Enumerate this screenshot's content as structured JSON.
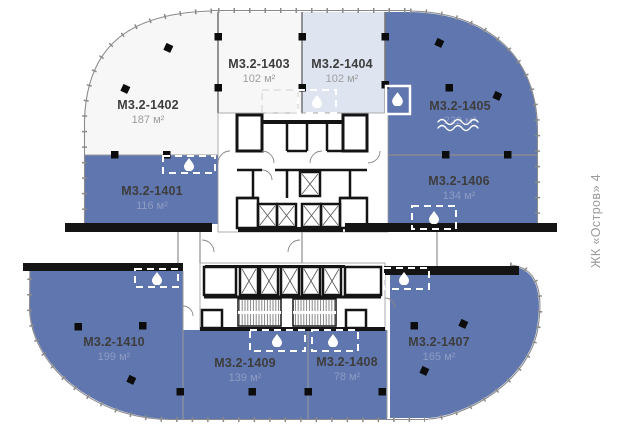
{
  "plan": {
    "vertical_label": "ЖК «Остров» 4",
    "units": [
      {
        "id": "М3.2-1401",
        "area": "116 м²",
        "fill": "#6076ae"
      },
      {
        "id": "М3.2-1402",
        "area": "187 м²",
        "fill": "#f7f7f7"
      },
      {
        "id": "М3.2-1403",
        "area": "102 м²",
        "fill": "#f7f7f7"
      },
      {
        "id": "М3.2-1404",
        "area": "102 м²",
        "fill": "#dee4f0"
      },
      {
        "id": "М3.2-1405",
        "area": "222 м²",
        "fill": "#6076ae"
      },
      {
        "id": "М3.2-1406",
        "area": "134 м²",
        "fill": "#6076ae"
      },
      {
        "id": "М3.2-1407",
        "area": "165 м²",
        "fill": "#6076ae"
      },
      {
        "id": "М3.2-1408",
        "area": "78 м²",
        "fill": "#6076ae"
      },
      {
        "id": "М3.2-1409",
        "area": "139 м²",
        "fill": "#6076ae"
      },
      {
        "id": "М3.2-1410",
        "area": "199 м²",
        "fill": "#6076ae"
      }
    ],
    "colors": {
      "unit_blue": "#6076ae",
      "unit_light_blue": "#dee4f0",
      "unit_white": "#f7f7f7",
      "wall": "#141414",
      "label_text": "#3d3d3d",
      "area_on_blue": "#8e9cc5",
      "area_on_white": "#9e9e9e",
      "muted_text": "#9b9b9b"
    },
    "icons": {
      "water_drop": "water-drop-icon",
      "waves": "waves-icon"
    }
  }
}
